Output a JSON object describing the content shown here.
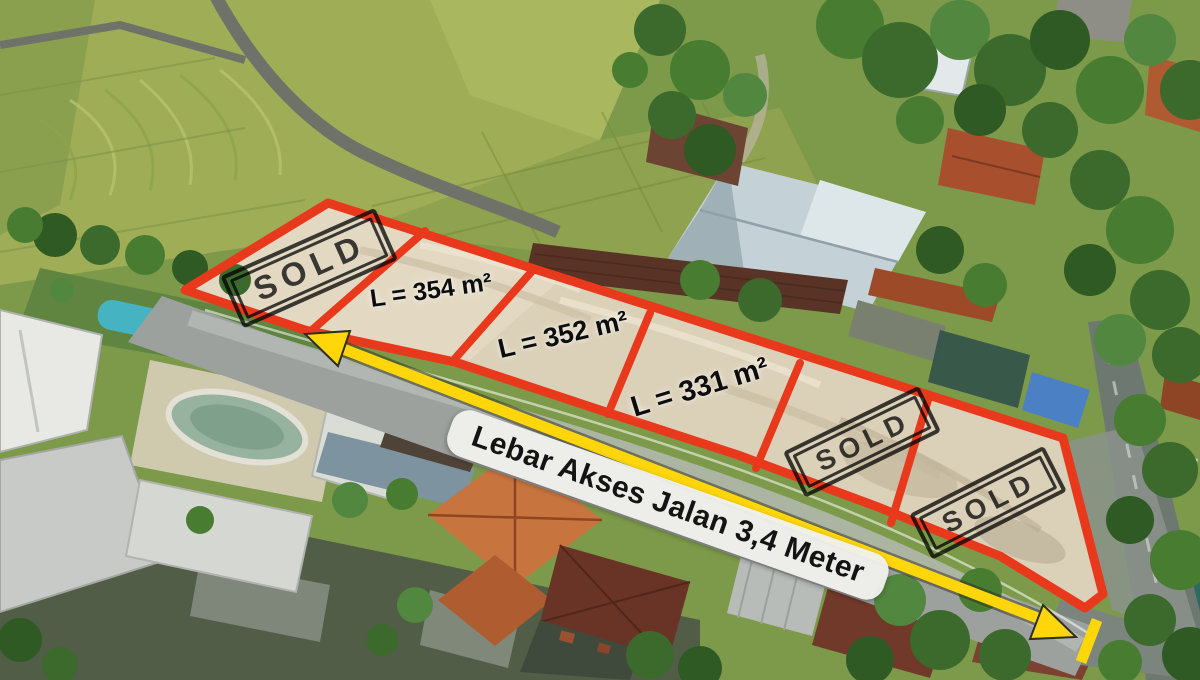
{
  "annotations": {
    "plots": [
      {
        "id": 1,
        "status": "sold",
        "label": "SOLD"
      },
      {
        "id": 2,
        "status": "available",
        "label": "L = 354 m²",
        "area_m2": 354
      },
      {
        "id": 3,
        "status": "available",
        "label": "L = 352 m²",
        "area_m2": 352
      },
      {
        "id": 4,
        "status": "available",
        "label": "L = 331 m²",
        "area_m2": 331
      },
      {
        "id": 5,
        "status": "sold",
        "label": "SOLD"
      },
      {
        "id": 6,
        "status": "sold",
        "label": "SOLD"
      }
    ],
    "road_width_label": "Lebar Akses Jalan 3,4 Meter",
    "road_width_meters": "3,4"
  },
  "colors": {
    "plot_outline": "#e8391d",
    "arrow_yellow": "#ffd60a",
    "stamp_ink": "#1e1e1e",
    "label_text": "#0d0d0d",
    "road_label_bg": "#f2f2ef"
  }
}
